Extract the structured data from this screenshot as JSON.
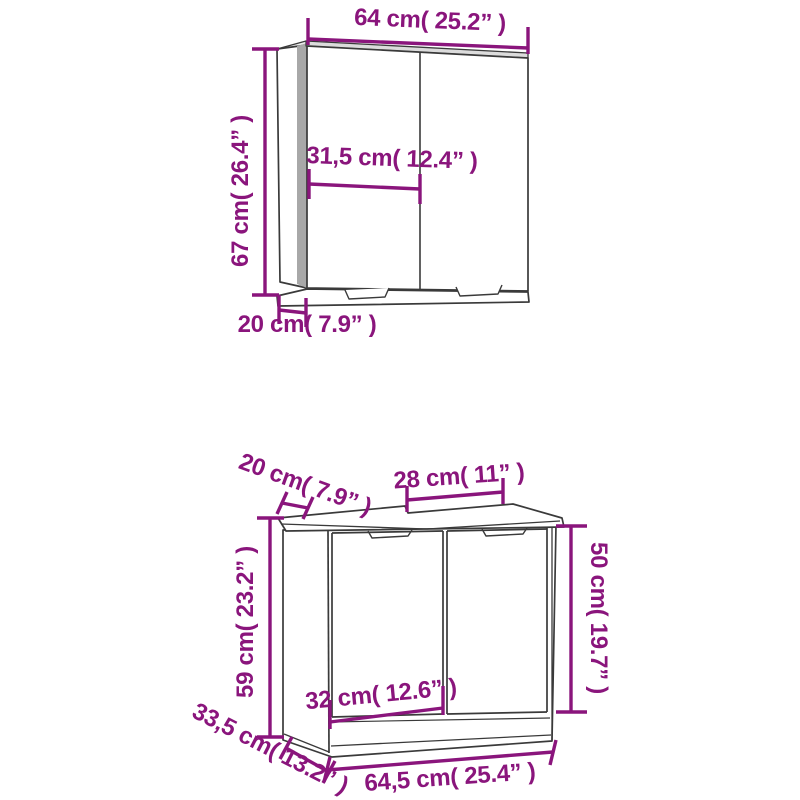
{
  "colors": {
    "background": "#ffffff",
    "dimension_accent": "#8a157c",
    "drawing_line": "#3a3a3a",
    "side_shade": "#a8a8a8"
  },
  "diagram": {
    "mirror_cabinet": {
      "dimensions": {
        "width": {
          "cm": "64",
          "inch": "25.2",
          "label": "64 cm( 25.2” )"
        },
        "height": {
          "cm": "67",
          "inch": "26.4",
          "label": "67 cm( 26.4” )"
        },
        "door_width": {
          "cm": "31,5",
          "inch": "12.4",
          "label": "31,5 cm( 12.4” )"
        },
        "depth": {
          "cm": "20",
          "inch": "7.9",
          "label": "20 cm( 7.9” )"
        }
      }
    },
    "sink_cabinet": {
      "dimensions": {
        "top_side_depth": {
          "cm": "20",
          "inch": "7.9",
          "label": "20 cm( 7.9” )"
        },
        "cutout_width": {
          "cm": "28",
          "inch": "11",
          "label": "28 cm( 11” )"
        },
        "door_height": {
          "cm": "50",
          "inch": "19.7",
          "label": "50 cm( 19.7” )"
        },
        "height": {
          "cm": "59",
          "inch": "23.2",
          "label": "59 cm( 23.2” )"
        },
        "door_width": {
          "cm": "32",
          "inch": "12.6",
          "label": "32 cm( 12.6” )"
        },
        "depth": {
          "cm": "33,5",
          "inch": "13.2",
          "label": "33,5 cm( 13.2” )"
        },
        "width": {
          "cm": "64,5",
          "inch": "25.4",
          "label": "64,5 cm( 25.4” )"
        }
      }
    }
  }
}
